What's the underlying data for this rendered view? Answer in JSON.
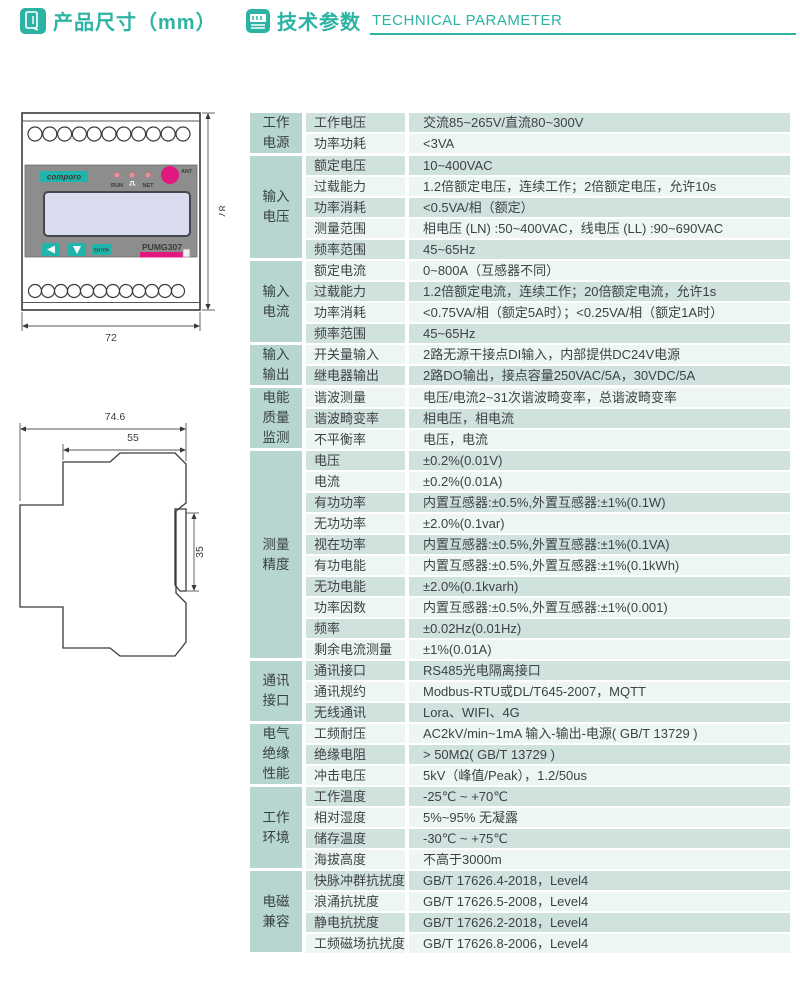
{
  "header": {
    "section1_title": "产品尺寸（mm）",
    "section2_title": "技术参数",
    "section2_subtitle": "TECHNICAL PARAMETER",
    "accent_color": "#2cb3a3"
  },
  "device_front": {
    "brand": "comporo",
    "model": "PUMG307",
    "led_run": "RUN",
    "led_net": "NET",
    "ant_label": "ANT",
    "enter_label": "ENTER",
    "dim_height": "87",
    "dim_width": "72",
    "terminals_top": 11,
    "terminals_bottom": 12
  },
  "device_side": {
    "dim_total_width": "74.6",
    "dim_body_width": "55",
    "dim_rail": "35"
  },
  "colors": {
    "accent": "#2cb3a3",
    "category_bg": "#b7d6cf",
    "row_green": "#cfe2dd",
    "row_light": "#edf6f3",
    "magenta": "#e0187f",
    "lcd": "#d9dbee",
    "panel_gray": "#8d8d8d"
  },
  "table": {
    "groups": [
      {
        "category": [
          "工作",
          "电源"
        ],
        "rows": [
          [
            "工作电压",
            "交流85~265V/直流80~300V"
          ],
          [
            "功率功耗",
            "<3VA"
          ]
        ]
      },
      {
        "category": [
          "输入",
          "电压"
        ],
        "rows": [
          [
            "额定电压",
            "10~400VAC"
          ],
          [
            "过载能力",
            "1.2倍额定电压，连续工作；2倍额定电压，允许10s"
          ],
          [
            "功率消耗",
            "<0.5VA/相（额定）"
          ],
          [
            "测量范围",
            "相电压 (LN) :50~400VAC，线电压 (LL) :90~690VAC"
          ],
          [
            "频率范围",
            "45~65Hz"
          ]
        ]
      },
      {
        "category": [
          "输入",
          "电流"
        ],
        "rows": [
          [
            "额定电流",
            "0~800A（互感器不同）"
          ],
          [
            "过载能力",
            "1.2倍额定电流，连续工作；20倍额定电流，允许1s"
          ],
          [
            "功率消耗",
            "<0.75VA/相（额定5A时）；<0.25VA/相（额定1A时）"
          ],
          [
            "频率范围",
            "45~65Hz"
          ]
        ]
      },
      {
        "category": [
          "输入",
          "输出"
        ],
        "rows": [
          [
            "开关量输入",
            "2路无源干接点DI输入，内部提供DC24V电源"
          ],
          [
            "继电器输出",
            "2路DO输出，接点容量250VAC/5A，30VDC/5A"
          ]
        ]
      },
      {
        "category": [
          "电能",
          "质量",
          "监测"
        ],
        "rows": [
          [
            "谐波测量",
            "电压/电流2~31次谐波畸变率，总谐波畸变率"
          ],
          [
            "谐波畸变率",
            "相电压，相电流"
          ],
          [
            "不平衡率",
            "电压，电流"
          ]
        ]
      },
      {
        "category": [
          "测量",
          "精度"
        ],
        "rows": [
          [
            "电压",
            "±0.2%(0.01V)"
          ],
          [
            "电流",
            "±0.2%(0.01A)"
          ],
          [
            "有功功率",
            "内置互感器:±0.5%,外置互感器:±1%(0.1W)"
          ],
          [
            "无功功率",
            "±2.0%(0.1var)"
          ],
          [
            "视在功率",
            "内置互感器:±0.5%,外置互感器:±1%(0.1VA)"
          ],
          [
            "有功电能",
            "内置互感器:±0.5%,外置互感器:±1%(0.1kWh)"
          ],
          [
            "无功电能",
            "±2.0%(0.1kvarh)"
          ],
          [
            "功率因数",
            "内置互感器:±0.5%,外置互感器:±1%(0.001)"
          ],
          [
            "频率",
            "±0.02Hz(0.01Hz)"
          ],
          [
            "剩余电流测量",
            "±1%(0.01A)"
          ]
        ]
      },
      {
        "category": [
          "通讯",
          "接口"
        ],
        "rows": [
          [
            "通讯接口",
            "RS485光电隔离接口"
          ],
          [
            "通讯规约",
            "Modbus-RTU或DL/T645-2007，MQTT"
          ],
          [
            "无线通讯",
            "Lora、WIFI、4G"
          ]
        ]
      },
      {
        "category": [
          "电气",
          "绝缘",
          "性能"
        ],
        "rows": [
          [
            "工频耐压",
            "AC2kV/min~1mA 输入-输出-电源( GB/T 13729 )"
          ],
          [
            "绝缘电阻",
            "> 50MΩ( GB/T 13729 )"
          ],
          [
            "冲击电压",
            "5kV（峰值/Peak），1.2/50us"
          ]
        ]
      },
      {
        "category": [
          "工作",
          "环境"
        ],
        "rows": [
          [
            "工作温度",
            "-25℃ ~ +70℃"
          ],
          [
            "相对湿度",
            "5%~95% 无凝露"
          ],
          [
            "储存温度",
            "-30℃ ~ +75℃"
          ],
          [
            "海拔高度",
            "不高于3000m"
          ]
        ]
      },
      {
        "category": [
          "电磁",
          "兼容"
        ],
        "rows": [
          [
            "快脉冲群抗扰度",
            "GB/T 17626.4-2018，Level4"
          ],
          [
            "浪涌抗扰度",
            "GB/T 17626.5-2008，Level4"
          ],
          [
            "静电抗扰度",
            "GB/T 17626.2-2018，Level4"
          ],
          [
            "工频磁场抗扰度",
            "GB/T 17626.8-2006，Level4"
          ]
        ]
      }
    ]
  }
}
